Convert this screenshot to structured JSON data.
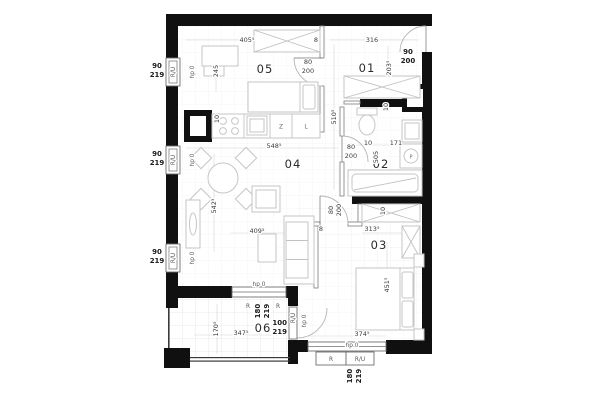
{
  "colors": {
    "wall": "#101010",
    "furniture_line": "#c6c6c6",
    "dim_text": "#3c3c3c"
  },
  "rooms": {
    "r01": "01",
    "r02": "02",
    "r03": "03",
    "r04": "04",
    "r05": "05",
    "r06": "06"
  },
  "dims": {
    "d405": "405⁵",
    "d316": "316",
    "d245": "245",
    "d203": "203⁵",
    "d510": "510⁵",
    "d548": "548⁵",
    "d542": "542³",
    "d409": "409⁵",
    "d313": "313⁵",
    "d451": "451⁵",
    "d374": "374⁵",
    "d347": "347⁵",
    "d170": "170⁵",
    "d171": "171",
    "d505": "505",
    "d10": "10",
    "d8": "8"
  },
  "openings": {
    "entry_w": "90",
    "entry_h": "200",
    "door_w": "80",
    "door_h": "200",
    "win_w": "90",
    "win_h": "219",
    "bwin_w": "180",
    "bwin_h": "219",
    "bdoor_w": "100",
    "bdoor_h": "219",
    "ru": "R/U",
    "r": "R",
    "hp": "hp 0"
  },
  "appliances": {
    "dishwasher": "Z",
    "fridge": "L",
    "washer": "P"
  }
}
